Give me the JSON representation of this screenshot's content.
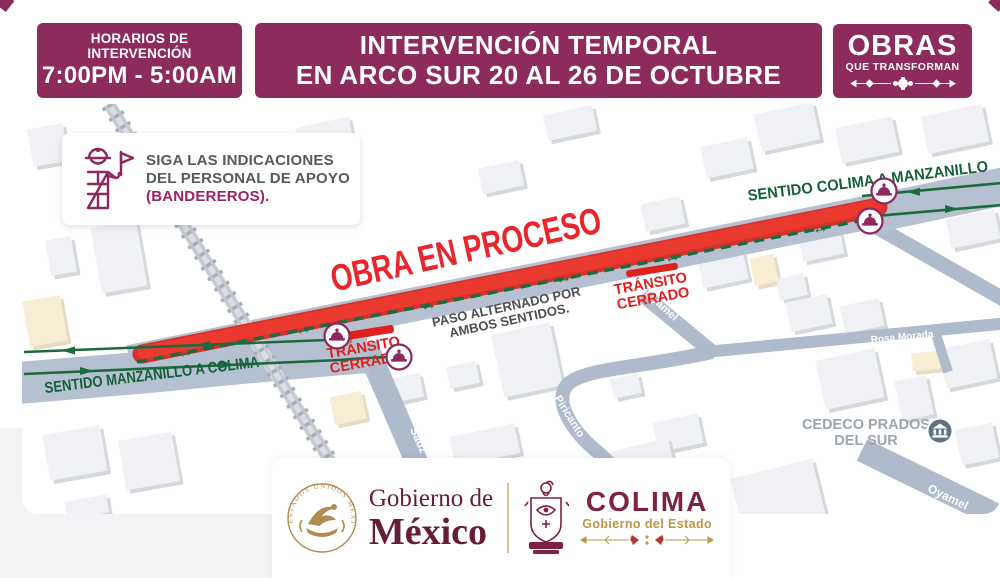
{
  "header": {
    "schedule": {
      "title": "HORARIOS DE INTERVENCIÓN",
      "hours": "7:00PM - 5:00AM"
    },
    "title": {
      "line1": "INTERVENCIÓN TEMPORAL",
      "line2": "EN ARCO SUR 20 AL 26 DE OCTUBRE"
    },
    "brand": {
      "name": "OBRAS",
      "tagline": "QUE TRANSFORMAN"
    }
  },
  "notice": {
    "line1": "SIGA LAS INDICACIONES",
    "line2": "DEL PERSONAL DE APOYO",
    "line3": "(BANDEREROS)."
  },
  "map": {
    "work_zone": "OBRA EN PROCESO",
    "alternating": {
      "line1": "PASO ALTERNADO POR",
      "line2": "AMBOS SENTIDOS."
    },
    "closed": {
      "line1": "TRÁNSITO",
      "line2": "CERRADO"
    },
    "direction_west": "SENTIDO MANZANILLO A COLIMA",
    "direction_east": "SENTIDO COLIMA A MANZANILLO",
    "streets": {
      "sauz": "Sauz",
      "piricanto": "Piricanto",
      "rosa_morada": "Rosa Morada",
      "ahuehuete": "Ahuehuete",
      "oyamel": "Oyamel"
    },
    "poi": {
      "line1": "CEDECO PRADOS",
      "line2": "DEL SUR"
    },
    "icons": {
      "both_directions_arrow": "↔"
    }
  },
  "footer": {
    "mexico": {
      "line1": "Gobierno de",
      "line2": "México",
      "seal": "ESTADOS UNIDOS MEXICANOS"
    },
    "colima": {
      "name": "COLIMA",
      "subtitle": "Gobierno del Estado"
    }
  },
  "colors": {
    "primary_maroon": "#8C2B5C",
    "work_red": "#E8342C",
    "traffic_green": "#1C6A3E",
    "road_grey": "#B5C1D1",
    "logo_maroon": "#7E2240",
    "logo_gold": "#BE9543"
  }
}
